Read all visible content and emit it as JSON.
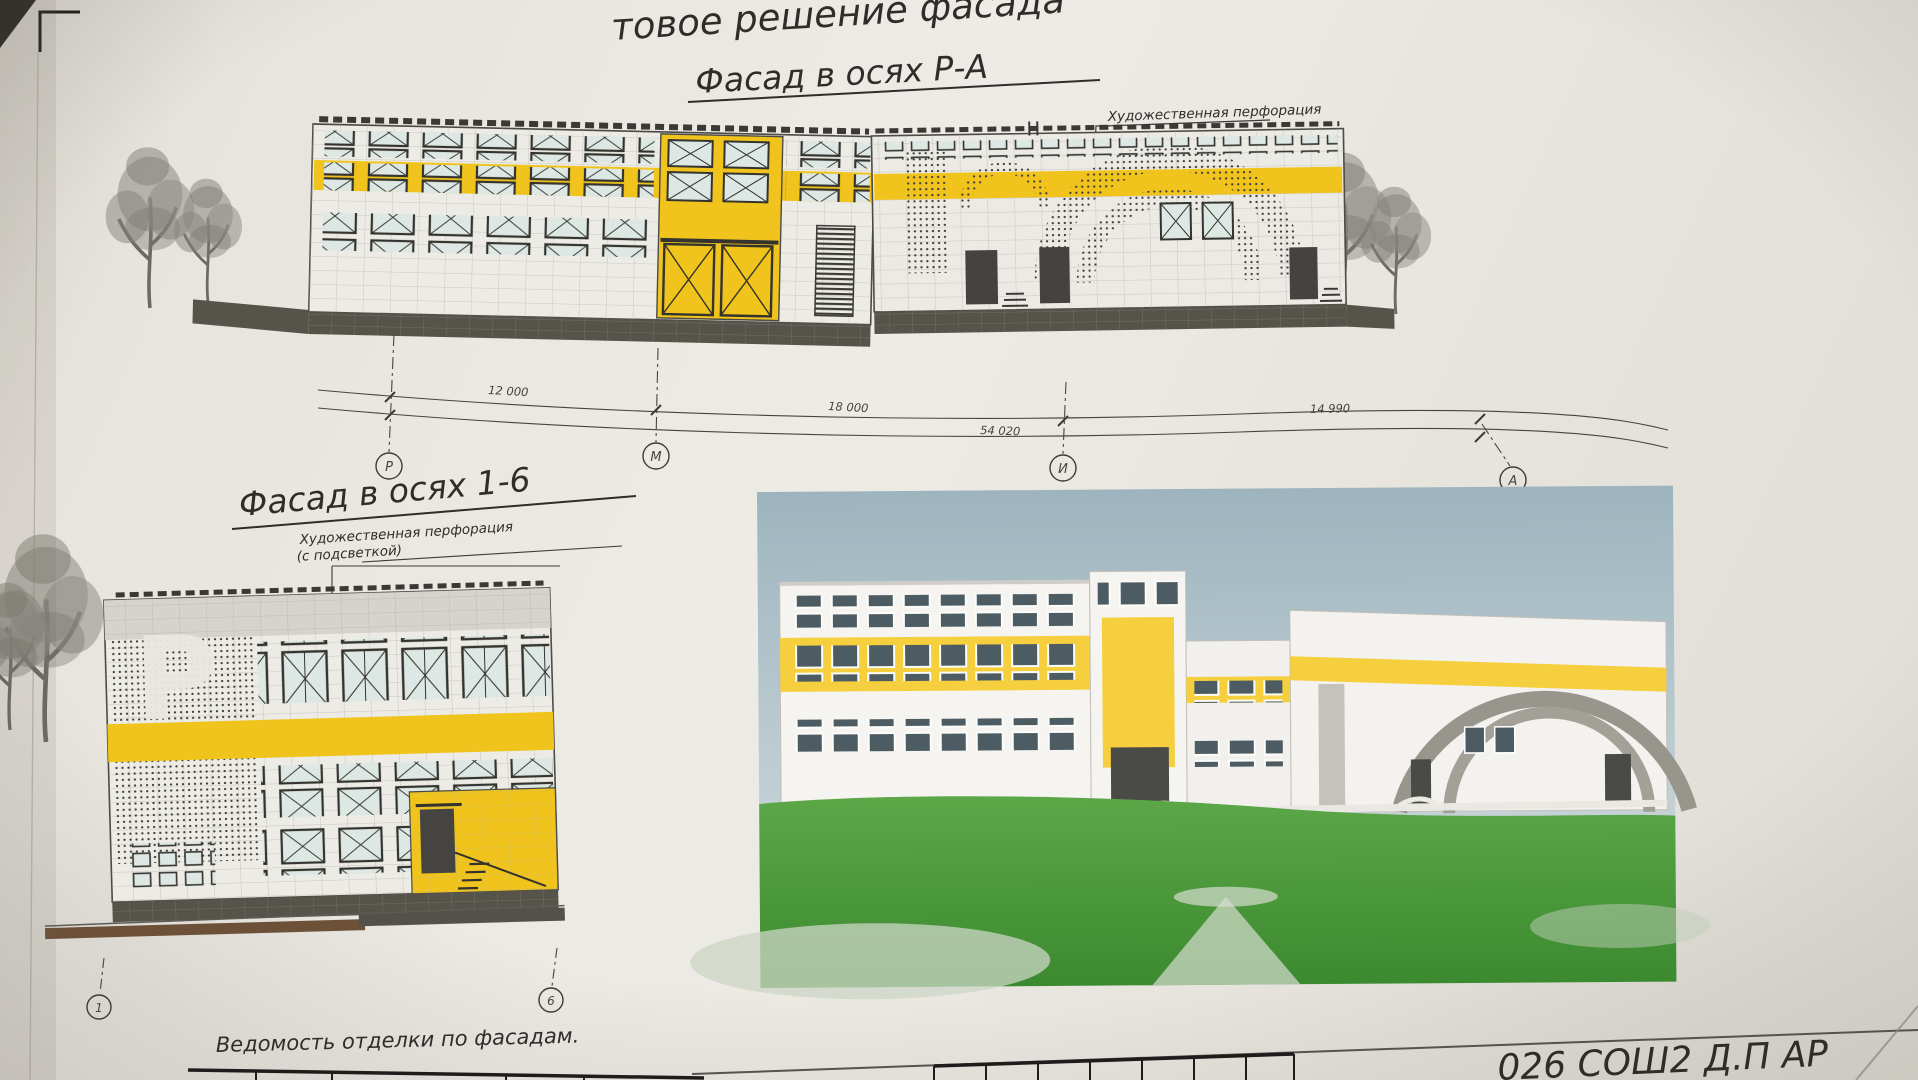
{
  "sheet": {
    "header_title": "товое решение фасада",
    "footer_label": "Ведомость отделки по фасадам.",
    "titleblock_code": "026 СОШ2 Д.П АР"
  },
  "facade_pa": {
    "title": "Фасад в осях Р-А",
    "annotation": "Художественная перфорация",
    "dims": [
      "12 000",
      "18 000",
      "54 020",
      "14 990"
    ],
    "axes": [
      "Р",
      "М",
      "И",
      "А"
    ]
  },
  "facade_16": {
    "title": "Фасад в осях 1-6",
    "annotation_line1": "Художественная перфорация",
    "annotation_line2": "(с подсветкой)",
    "perforation_glyph": "Р",
    "axes": [
      "1",
      "6"
    ]
  },
  "colors": {
    "accent_yellow": "#f0c41c",
    "plinth_dark": "#55524a",
    "paper": "#e9e6e0",
    "sky": "#a9bfc8",
    "grass": "#4f9e3d"
  }
}
